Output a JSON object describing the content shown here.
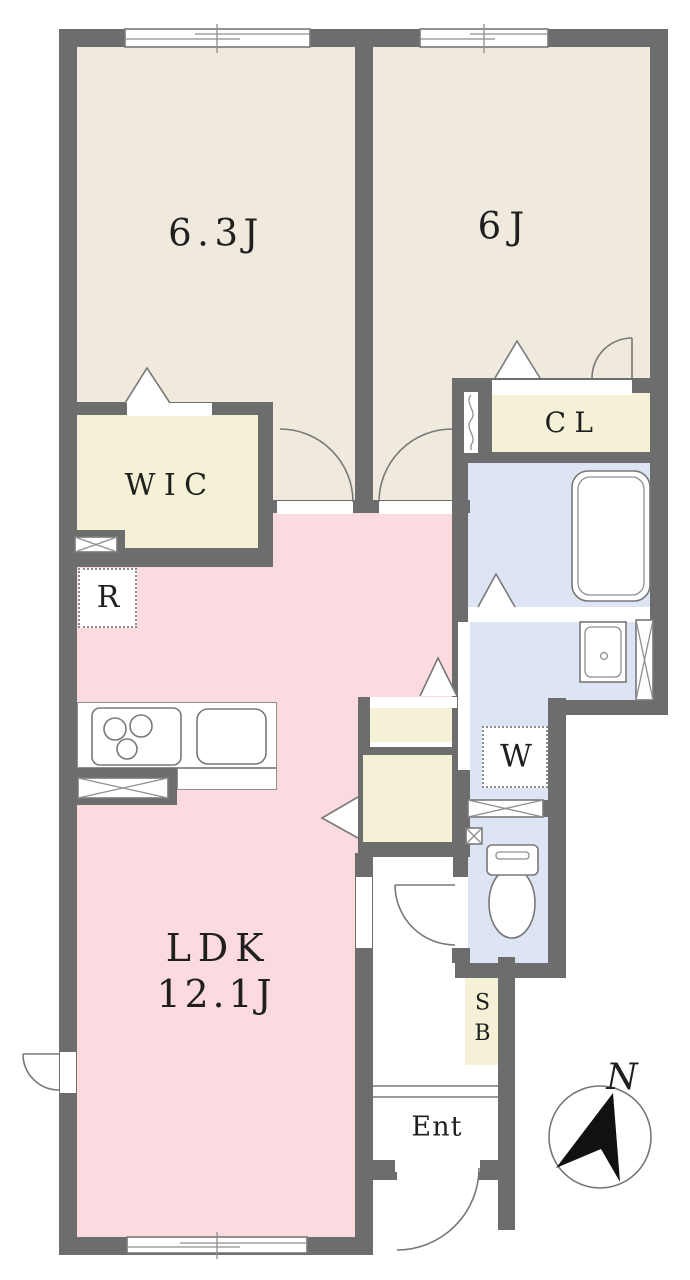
{
  "rooms": {
    "bedroom1": {
      "label": "6.3J"
    },
    "bedroom2": {
      "label": "6J"
    },
    "wic": {
      "label": "WIC"
    },
    "closet": {
      "label": "CL"
    },
    "ldk": {
      "label": "LDK",
      "size": "12.1J"
    },
    "refrigerator": {
      "label": "R"
    },
    "washer": {
      "label": "W"
    },
    "shoe_box": {
      "label": "SB"
    },
    "entrance": {
      "label": "Ent"
    }
  },
  "compass": {
    "north_label": "N"
  },
  "colors": {
    "wall": "#6d6d6d",
    "room_beige": "#f0e9dd",
    "storage_yellow": "#f5f1d6",
    "ldk_pink": "#fbdbe0",
    "wet_area_blue": "#dde4f3",
    "fixture_line": "#787878",
    "label_ink": "#1f1f1f",
    "needle_black": "#111111"
  }
}
